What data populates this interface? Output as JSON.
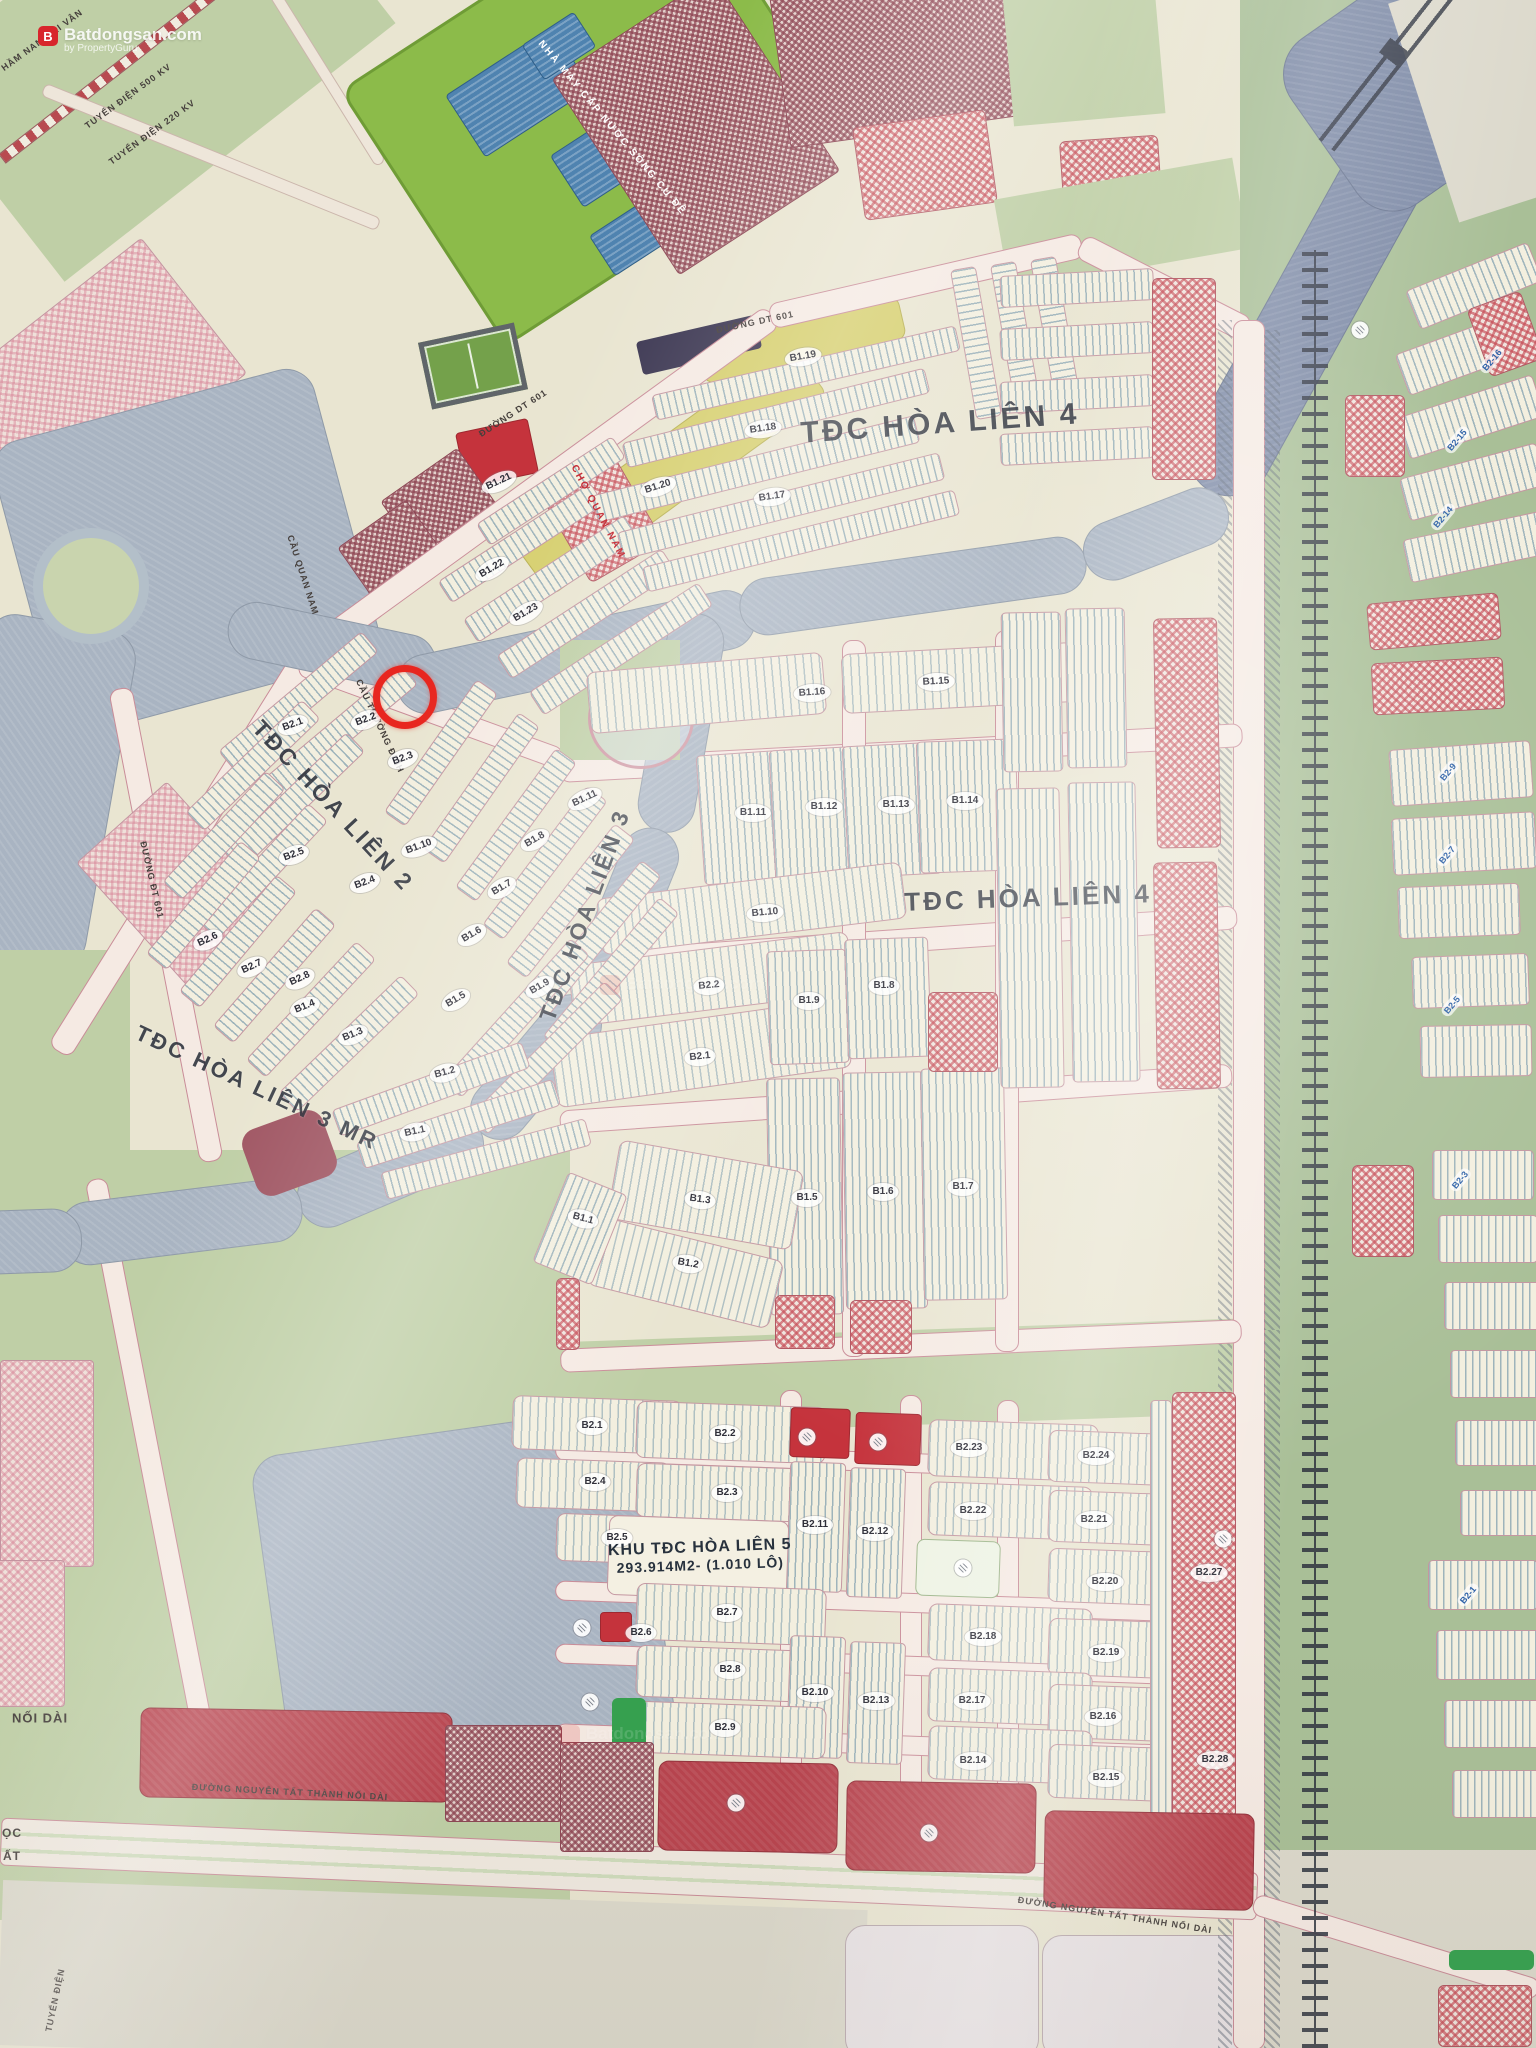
{
  "watermark": {
    "brand": "Batdongsan.com",
    "sub": "by PropertyGuru",
    "logo_letter": "B"
  },
  "marker": {
    "x": 405,
    "y": 697,
    "color": "#e8261f"
  },
  "hl5": {
    "title": "KHU TĐC HÒA LIÊN 5",
    "area": "293.914M2- (1.010 LÔ)",
    "x": 700,
    "y": 1556
  },
  "big_labels": [
    {
      "text": "TĐC HÒA LIÊN 4",
      "x": 940,
      "y": 424,
      "rot": -4,
      "size": 30
    },
    {
      "text": "TĐC HÒA LIÊN 4",
      "x": 1028,
      "y": 898,
      "rot": -2,
      "size": 26
    },
    {
      "text": "TĐC HÒA LIÊN 2",
      "x": 333,
      "y": 806,
      "rot": 47,
      "size": 23
    },
    {
      "text": "TĐC HÒA LIÊN 3",
      "x": 585,
      "y": 915,
      "rot": -70,
      "size": 23
    },
    {
      "text": "TĐC HÒA LIÊN 3 MR",
      "x": 257,
      "y": 1088,
      "rot": 25,
      "size": 22
    }
  ],
  "special_labels": [
    {
      "text": "NHÀ MÁY CẤP NƯỚC SÔNG CU ĐÊ",
      "x": 612,
      "y": 128,
      "rot": 50,
      "color": "#ffffff",
      "size": 10
    },
    {
      "text": "CHỢ QUAN NAM",
      "x": 598,
      "y": 512,
      "rot": 62,
      "color": "#c21f2a",
      "size": 10
    }
  ],
  "road_labels": [
    {
      "text": "ĐƯỜNG DT 601",
      "x": 513,
      "y": 413,
      "rot": -33
    },
    {
      "text": "ĐƯỜNG DT 601",
      "x": 755,
      "y": 322,
      "rot": -12
    },
    {
      "text": "ĐƯỜNG ĐT 601",
      "x": 152,
      "y": 880,
      "rot": 77
    },
    {
      "text": "CẦU QUAN NAM",
      "x": 303,
      "y": 575,
      "rot": 72
    },
    {
      "text": "CẦU TRƯỜNG ĐỊNH",
      "x": 380,
      "y": 726,
      "rot": 65
    },
    {
      "text": "ĐƯỜNG NGUYỄN TẤT THÀNH NỐI DÀI",
      "x": 290,
      "y": 1792,
      "rot": 3
    },
    {
      "text": "ĐƯỜNG NGUYỄN TẤT THÀNH NỐI DÀI",
      "x": 1115,
      "y": 1915,
      "rot": 9
    },
    {
      "text": "NỐI DÀI",
      "x": 40,
      "y": 1718,
      "rot": 0,
      "size": 13
    },
    {
      "text": "TUYẾN ĐIỆN",
      "x": 55,
      "y": 2000,
      "rot": -78
    },
    {
      "text": "TUYẾN ĐIỆN 500 KV",
      "x": 128,
      "y": 96,
      "rot": -36
    },
    {
      "text": "TUYẾN ĐIỆN 220 KV",
      "x": 152,
      "y": 132,
      "rot": -36
    },
    {
      "text": "HẦM NAM HẢI VÂN",
      "x": 42,
      "y": 40,
      "rot": -36
    },
    {
      "text": "ỌC",
      "x": 12,
      "y": 1833,
      "rot": 0,
      "size": 12
    },
    {
      "text": "ẤT",
      "x": 12,
      "y": 1856,
      "rot": 0,
      "size": 12
    }
  ],
  "block_labels": [
    {
      "text": "B1.19",
      "x": 803,
      "y": 357,
      "rot": -10
    },
    {
      "text": "B1.18",
      "x": 763,
      "y": 429,
      "rot": -8
    },
    {
      "text": "B1.17",
      "x": 772,
      "y": 497,
      "rot": -8
    },
    {
      "text": "B1.20",
      "x": 658,
      "y": 487,
      "rot": -18
    },
    {
      "text": "B1.21",
      "x": 499,
      "y": 482,
      "rot": -25
    },
    {
      "text": "B1.22",
      "x": 492,
      "y": 569,
      "rot": -30
    },
    {
      "text": "B1.23",
      "x": 526,
      "y": 613,
      "rot": -30
    },
    {
      "text": "B1.16",
      "x": 812,
      "y": 693,
      "rot": -4
    },
    {
      "text": "B1.15",
      "x": 936,
      "y": 682,
      "rot": -3
    },
    {
      "text": "B1.11",
      "x": 753,
      "y": 813,
      "rot": 0
    },
    {
      "text": "B1.12",
      "x": 824,
      "y": 807,
      "rot": 0
    },
    {
      "text": "B1.13",
      "x": 896,
      "y": 805,
      "rot": 0
    },
    {
      "text": "B1.14",
      "x": 965,
      "y": 801,
      "rot": 0
    },
    {
      "text": "B1.10",
      "x": 765,
      "y": 913,
      "rot": -5
    },
    {
      "text": "B2.2",
      "x": 709,
      "y": 986,
      "rot": -5
    },
    {
      "text": "B1.9",
      "x": 809,
      "y": 1001,
      "rot": 0
    },
    {
      "text": "B1.8",
      "x": 884,
      "y": 986,
      "rot": 0
    },
    {
      "text": "B2.1",
      "x": 700,
      "y": 1057,
      "rot": -6
    },
    {
      "text": "B1.1",
      "x": 583,
      "y": 1219,
      "rot": 15
    },
    {
      "text": "B1.3",
      "x": 700,
      "y": 1200,
      "rot": 8
    },
    {
      "text": "B1.5",
      "x": 807,
      "y": 1198,
      "rot": 0
    },
    {
      "text": "B1.6",
      "x": 883,
      "y": 1192,
      "rot": 0
    },
    {
      "text": "B1.7",
      "x": 963,
      "y": 1187,
      "rot": 0
    },
    {
      "text": "B1.2",
      "x": 688,
      "y": 1264,
      "rot": 10
    },
    {
      "text": "B2.1",
      "x": 293,
      "y": 725,
      "rot": -20
    },
    {
      "text": "B2.2",
      "x": 366,
      "y": 720,
      "rot": -20
    },
    {
      "text": "B2.3",
      "x": 403,
      "y": 759,
      "rot": -20
    },
    {
      "text": "B2.5",
      "x": 294,
      "y": 855,
      "rot": -20
    },
    {
      "text": "B2.4",
      "x": 365,
      "y": 883,
      "rot": -20
    },
    {
      "text": "B1.10",
      "x": 419,
      "y": 847,
      "rot": -20
    },
    {
      "text": "B1.11",
      "x": 585,
      "y": 799,
      "rot": -25
    },
    {
      "text": "B2.6",
      "x": 208,
      "y": 940,
      "rot": -25
    },
    {
      "text": "B2.7",
      "x": 252,
      "y": 967,
      "rot": -25
    },
    {
      "text": "B2.8",
      "x": 300,
      "y": 979,
      "rot": -25
    },
    {
      "text": "B1.4",
      "x": 305,
      "y": 1007,
      "rot": -22
    },
    {
      "text": "B1.3",
      "x": 353,
      "y": 1035,
      "rot": -22
    },
    {
      "text": "B1.5",
      "x": 456,
      "y": 1000,
      "rot": -30
    },
    {
      "text": "B1.9",
      "x": 540,
      "y": 987,
      "rot": -30
    },
    {
      "text": "B1.6",
      "x": 472,
      "y": 935,
      "rot": -30
    },
    {
      "text": "B1.7",
      "x": 502,
      "y": 888,
      "rot": -30
    },
    {
      "text": "B1.8",
      "x": 535,
      "y": 840,
      "rot": -30
    },
    {
      "text": "B1.2",
      "x": 445,
      "y": 1073,
      "rot": -15
    },
    {
      "text": "B1.1",
      "x": 415,
      "y": 1132,
      "rot": -12
    },
    {
      "text": "B2.1",
      "x": 592,
      "y": 1426,
      "rot": 0
    },
    {
      "text": "B2.2",
      "x": 725,
      "y": 1434,
      "rot": 0
    },
    {
      "text": "B2.23",
      "x": 969,
      "y": 1448,
      "rot": 0
    },
    {
      "text": "B2.24",
      "x": 1096,
      "y": 1456,
      "rot": 0
    },
    {
      "text": "B2.4",
      "x": 595,
      "y": 1482,
      "rot": 0
    },
    {
      "text": "B2.3",
      "x": 727,
      "y": 1493,
      "rot": 0
    },
    {
      "text": "B2.11",
      "x": 815,
      "y": 1525,
      "rot": 0
    },
    {
      "text": "B2.12",
      "x": 875,
      "y": 1532,
      "rot": 0
    },
    {
      "text": "B2.22",
      "x": 973,
      "y": 1511,
      "rot": 0
    },
    {
      "text": "B2.21",
      "x": 1094,
      "y": 1520,
      "rot": 0
    },
    {
      "text": "B2.5",
      "x": 617,
      "y": 1538,
      "rot": 0
    },
    {
      "text": "B2.20",
      "x": 1105,
      "y": 1582,
      "rot": 0
    },
    {
      "text": "B2.27",
      "x": 1209,
      "y": 1573,
      "rot": 0
    },
    {
      "text": "B2.7",
      "x": 727,
      "y": 1613,
      "rot": 0
    },
    {
      "text": "B2.6",
      "x": 641,
      "y": 1633,
      "rot": 0
    },
    {
      "text": "B2.18",
      "x": 983,
      "y": 1637,
      "rot": 0
    },
    {
      "text": "B2.19",
      "x": 1106,
      "y": 1653,
      "rot": 0
    },
    {
      "text": "B2.8",
      "x": 730,
      "y": 1670,
      "rot": 0
    },
    {
      "text": "B2.10",
      "x": 815,
      "y": 1693,
      "rot": 0
    },
    {
      "text": "B2.13",
      "x": 876,
      "y": 1701,
      "rot": 0
    },
    {
      "text": "B2.17",
      "x": 972,
      "y": 1701,
      "rot": 0
    },
    {
      "text": "B2.16",
      "x": 1103,
      "y": 1717,
      "rot": 0
    },
    {
      "text": "B2.9",
      "x": 725,
      "y": 1728,
      "rot": 0
    },
    {
      "text": "B2.14",
      "x": 973,
      "y": 1761,
      "rot": 0
    },
    {
      "text": "B2.28",
      "x": 1215,
      "y": 1760,
      "rot": 0
    },
    {
      "text": "B2.15",
      "x": 1106,
      "y": 1778,
      "rot": 0
    }
  ],
  "blue_labels": [
    {
      "text": "B2-16",
      "x": 1492,
      "y": 360,
      "rot": -50
    },
    {
      "text": "B2-15",
      "x": 1457,
      "y": 440,
      "rot": -50
    },
    {
      "text": "B2-14",
      "x": 1443,
      "y": 517,
      "rot": -50
    },
    {
      "text": "B2-9",
      "x": 1448,
      "y": 772,
      "rot": -50
    },
    {
      "text": "B2-7",
      "x": 1447,
      "y": 855,
      "rot": -50
    },
    {
      "text": "B2-5",
      "x": 1452,
      "y": 1005,
      "rot": -50
    },
    {
      "text": "B2-3",
      "x": 1460,
      "y": 1180,
      "rot": -50
    },
    {
      "text": "B2-1",
      "x": 1468,
      "y": 1595,
      "rot": -50
    }
  ],
  "white_chips": [
    {
      "x": 807,
      "y": 1437
    },
    {
      "x": 878,
      "y": 1442
    },
    {
      "x": 963,
      "y": 1568
    },
    {
      "x": 736,
      "y": 1803
    },
    {
      "x": 929,
      "y": 1833
    },
    {
      "x": 1223,
      "y": 1539
    },
    {
      "x": 582,
      "y": 1628
    },
    {
      "x": 590,
      "y": 1702
    },
    {
      "x": 1360,
      "y": 330
    }
  ]
}
